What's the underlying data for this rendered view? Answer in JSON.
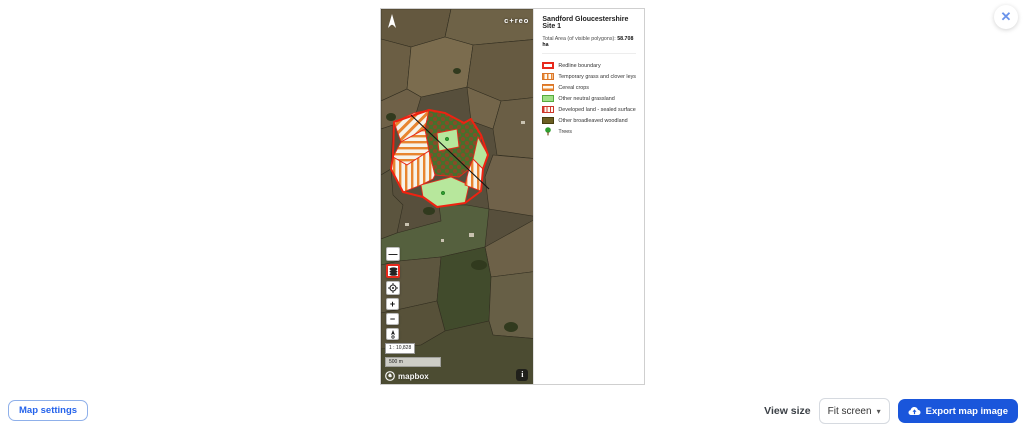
{
  "window": {
    "close_icon": "✕"
  },
  "map": {
    "logo_text": "c+reo",
    "scale_ratio": "1 : 10,828",
    "scale_bar_label": "500 m",
    "attribution_text": "mapbox",
    "controls": {
      "collapse": "—",
      "zoom_in": "+",
      "zoom_out": "−",
      "info": "i"
    }
  },
  "legend": {
    "title": "Sandford Gloucestershire Site 1",
    "total_area_label": "Total Area (of visible polygons): ",
    "total_area_value": "58.708 ha",
    "items": [
      {
        "label": "Redline boundary"
      },
      {
        "label": "Temporary grass and clover leys"
      },
      {
        "label": "Cereal crops"
      },
      {
        "label": "Other neutral grassland"
      },
      {
        "label": "Developed land - sealed surface"
      },
      {
        "label": "Other broadleaved woodland"
      },
      {
        "label": "Trees"
      }
    ]
  },
  "footer": {
    "map_settings_label": "Map settings",
    "view_size_label": "View size",
    "view_size_value": "Fit screen",
    "chevron_down": "▾",
    "export_label": "Export map image"
  },
  "colors": {
    "accent_blue": "#2563eb",
    "export_blue": "#1a56db",
    "redline_red": "#e8291c",
    "stripe_orange": "#e8852f",
    "grassland_green": "#b7e79c",
    "woodland_olive": "#6b5e22",
    "tree_green": "#2f9e2f"
  }
}
